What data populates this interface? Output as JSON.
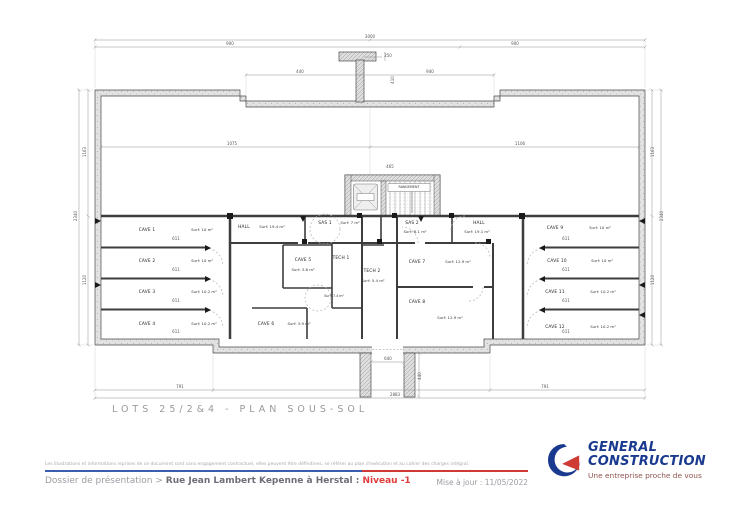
{
  "title": "LOTS 25/2&4 - PLAN SOUS-SOL",
  "plan": {
    "rooms": [
      {
        "name": "CAVE 1",
        "surf": "Surf: 10 m²",
        "nx": 147,
        "ny": 231,
        "sx": 202,
        "sy": 231
      },
      {
        "name": "CAVE 2",
        "surf": "Surf: 10 m²",
        "nx": 147,
        "ny": 262,
        "sx": 202,
        "sy": 262
      },
      {
        "name": "CAVE 3",
        "surf": "Surf: 10.2 m²",
        "nx": 147,
        "ny": 293,
        "sx": 204,
        "sy": 293
      },
      {
        "name": "CAVE 4",
        "surf": "Surf: 10.2 m²",
        "nx": 147,
        "ny": 325,
        "sx": 204,
        "sy": 325
      },
      {
        "name": "HALL",
        "surf": "Surf: 19.4 m²",
        "nx": 244,
        "ny": 228,
        "sx": 272,
        "sy": 228
      },
      {
        "name": "SAS 1",
        "surf": "Surf: 7 m²",
        "nx": 325,
        "ny": 224,
        "sx": 350,
        "sy": 224
      },
      {
        "name": "SAS 2",
        "surf": "Surf: 8.1 m²",
        "nx": 412,
        "ny": 224,
        "sx": 415,
        "sy": 233
      },
      {
        "name": "HALL",
        "surf": "Surf: 19.1 m²",
        "nx": 479,
        "ny": 224,
        "sx": 477,
        "sy": 233
      },
      {
        "name": "TECH 1",
        "surf": "",
        "nx": 341,
        "ny": 259,
        "sx": 0,
        "sy": 0
      },
      {
        "name": "TECH 2",
        "surf": "Surf: 5.4 m²",
        "nx": 372,
        "ny": 272,
        "sx": 373,
        "sy": 282
      },
      {
        "name": "CAVE 5",
        "surf": "Surf: 3.6 m²",
        "nx": 303,
        "ny": 261,
        "sx": 303,
        "sy": 271
      },
      {
        "name": "CAVE 6",
        "surf": "Surf: 3.9 m²",
        "nx": 266,
        "ny": 325,
        "sx": 299,
        "sy": 325
      },
      {
        "name": "CAVE 7",
        "surf": "Surf: 12.9 m²",
        "nx": 417,
        "ny": 263,
        "sx": 458,
        "sy": 263
      },
      {
        "name": "CAVE 8",
        "surf": "Surf: 12.9 m²",
        "nx": 417,
        "ny": 303,
        "sx": 450,
        "sy": 319
      },
      {
        "name": "CAVE 9",
        "surf": "Surf: 10 m²",
        "nx": 555,
        "ny": 229,
        "sx": 600,
        "sy": 229
      },
      {
        "name": "CAVE 10",
        "surf": "Surf: 10 m²",
        "nx": 557,
        "ny": 262,
        "sx": 602,
        "sy": 262
      },
      {
        "name": "CAVE 11",
        "surf": "Surf: 10.2 m²",
        "nx": 555,
        "ny": 293,
        "sx": 603,
        "sy": 293
      },
      {
        "name": "CAVE 12",
        "surf": "Surf: 10.2 m²",
        "nx": 555,
        "ny": 328,
        "sx": 603,
        "sy": 328
      }
    ],
    "extra_labels": [
      {
        "text": "RANGEMENT",
        "x": 409,
        "y": 188
      },
      {
        "text": "Surf: 7.4 m²",
        "x": 334,
        "y": 297
      }
    ],
    "dimensions": [
      {
        "text": "3000",
        "x": 370,
        "y": 38
      },
      {
        "text": "900",
        "x": 230,
        "y": 45
      },
      {
        "text": "900",
        "x": 515,
        "y": 45
      },
      {
        "text": "440",
        "x": 300,
        "y": 73
      },
      {
        "text": "940",
        "x": 430,
        "y": 73
      },
      {
        "text": "250",
        "x": 388,
        "y": 57
      },
      {
        "text": "410",
        "x": 394,
        "y": 80,
        "rot": true
      },
      {
        "text": "1075",
        "x": 232,
        "y": 145
      },
      {
        "text": "1106",
        "x": 520,
        "y": 145
      },
      {
        "text": "465",
        "x": 390,
        "y": 168
      },
      {
        "text": "1163",
        "x": 86,
        "y": 152,
        "rot": true
      },
      {
        "text": "1120",
        "x": 86,
        "y": 280,
        "rot": true
      },
      {
        "text": "2340",
        "x": 77,
        "y": 216,
        "rot": true
      },
      {
        "text": "1163",
        "x": 654,
        "y": 152,
        "rot": true
      },
      {
        "text": "1120",
        "x": 654,
        "y": 280,
        "rot": true
      },
      {
        "text": "2340",
        "x": 663,
        "y": 216,
        "rot": true
      },
      {
        "text": "640",
        "x": 388,
        "y": 360
      },
      {
        "text": "440",
        "x": 421,
        "y": 376,
        "rot": true
      },
      {
        "text": "791",
        "x": 180,
        "y": 388
      },
      {
        "text": "791",
        "x": 545,
        "y": 388
      },
      {
        "text": "2883",
        "x": 395,
        "y": 396
      },
      {
        "text": "611",
        "x": 176,
        "y": 240
      },
      {
        "text": "611",
        "x": 176,
        "y": 271
      },
      {
        "text": "611",
        "x": 176,
        "y": 302
      },
      {
        "text": "611",
        "x": 176,
        "y": 333
      },
      {
        "text": "611",
        "x": 566,
        "y": 240
      },
      {
        "text": "611",
        "x": 566,
        "y": 271
      },
      {
        "text": "611",
        "x": 566,
        "y": 302
      },
      {
        "text": "611",
        "x": 566,
        "y": 333
      }
    ]
  },
  "footer": {
    "disclaimer": "Les illustrations et informations reprises de ce document sont sans engagement contractuel, elles peuvent être définitives, se référer au plan d'exécution et au cahier des charges intégral.",
    "breadcrumb_prefix": "Dossier de présentation > ",
    "breadcrumb_main": "Rue Jean Lambert Kepenne à Herstal : ",
    "breadcrumb_level": "Niveau -1",
    "updated": "Mise à jour : 11/05/2022",
    "logo": {
      "line1": "GENERAL",
      "line2": "CONSTRUCTION",
      "tagline": "Une entreprise proche de vous"
    },
    "colors": {
      "logo_blue": "#1a3a8f",
      "logo_red": "#cf3a35",
      "level_red": "#e23b3b",
      "rule_blue": "#3a5dae",
      "rule_red": "#cf3a35"
    }
  }
}
